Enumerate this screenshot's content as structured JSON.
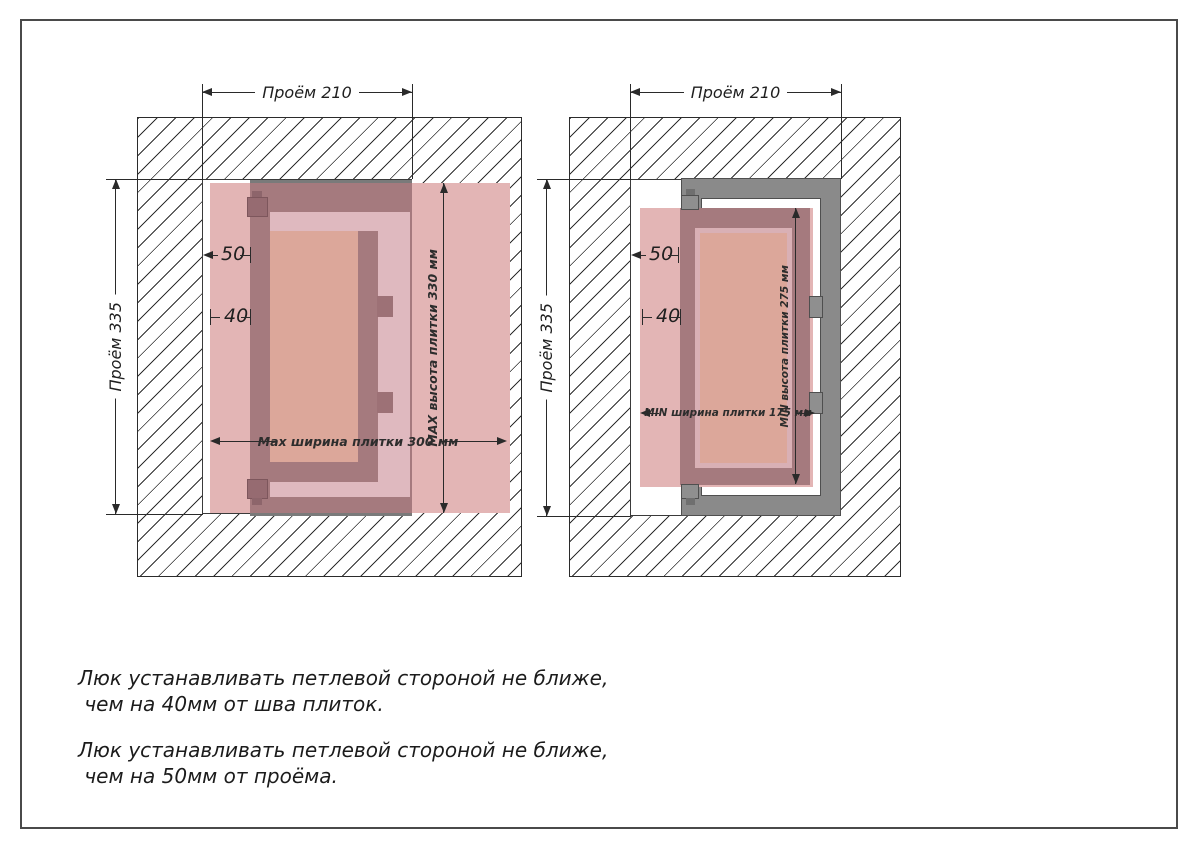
{
  "colors": {
    "tile_pink": "#e3b5b5",
    "door_dark": "#a57a7e",
    "door_gap_light": "#dfb9bf",
    "door_panel_salmon": "#dca79a",
    "frame_gray": "#8a8a8a",
    "hatch_line": "#2e2e2e",
    "dimension_text": "#1f1f1f"
  },
  "left_diagram": {
    "dim_opening_width": "Проём 210",
    "dim_opening_height": "Проём 335",
    "dim_hinge_to_opening": "50",
    "dim_hinge_to_seam": "40",
    "dim_tile_width": "Max ширина плитки 300 мм",
    "dim_tile_height": "MAX высота плитки 330 мм"
  },
  "right_diagram": {
    "dim_opening_width": "Проём 210",
    "dim_opening_height": "Проём 335",
    "dim_hinge_to_opening": "50",
    "dim_hinge_to_seam": "40",
    "dim_tile_width": "MIN ширина плитки 175 мм",
    "dim_tile_height": "MIN высота плитки 275 мм"
  },
  "notes": {
    "note_seam": "Люк устанавливать петлевой стороной не ближе,\n чем на 40мм от шва плиток.",
    "note_opening": "Люк устанавливать петлевой стороной не ближе,\n чем на 50мм от проёма."
  }
}
